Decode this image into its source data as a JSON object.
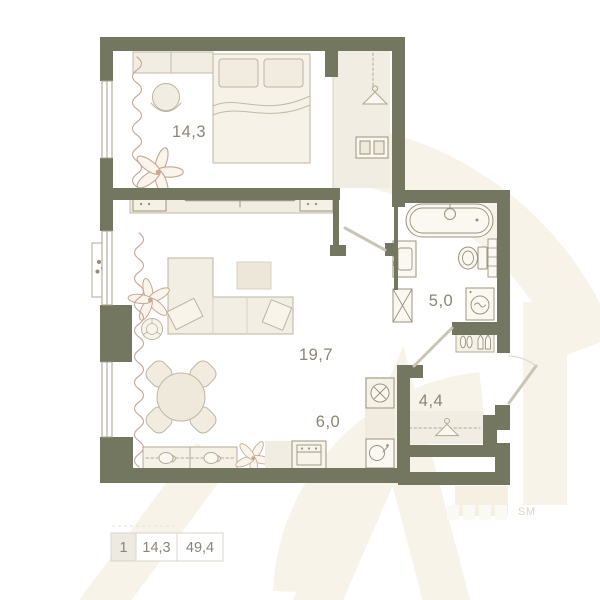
{
  "plan": {
    "type": "apartment-floor-plan",
    "labels": {
      "bedroom": "14,3",
      "living": "19,7",
      "bathroom": "5,0",
      "kitchen": "6,0",
      "hall": "4,4"
    },
    "rooms": [
      {
        "name": "bedroom",
        "area_m2": "14,3"
      },
      {
        "name": "living-room",
        "area_m2": "19,7"
      },
      {
        "name": "bathroom",
        "area_m2": "5,0"
      },
      {
        "name": "kitchen",
        "area_m2": "6,0"
      },
      {
        "name": "hallway",
        "area_m2": "4,4"
      }
    ],
    "fixtures": [
      "bed",
      "closet",
      "wardrobe-hanger",
      "drawer-cabinet",
      "armchair",
      "plant",
      "curtains",
      "tv-console",
      "sofa",
      "coffee-table",
      "pouf",
      "dining-table",
      "dining-chairs",
      "kitchen-counter",
      "stove",
      "cooker-hood",
      "kitchen-sink",
      "bathtub",
      "bathroom-sink",
      "toilet",
      "towel-rail",
      "washing-machine",
      "ventilation-shaft",
      "shoe-rack",
      "coat-hanger",
      "entrance-door",
      "interior-doors",
      "windows",
      "balcony-shelf"
    ]
  },
  "legend": {
    "rooms_count": "1",
    "living_area": "14,3",
    "total_area": "49,4"
  },
  "watermark": {
    "trademark_suffix": "SM"
  },
  "colors": {
    "wall": "#747760",
    "furniture_fill": "#f2ede2",
    "furniture_stroke": "#bcb4a0",
    "plumbing_stroke": "#a8a18c",
    "soft_line": "#c7a795",
    "label_text": "#8c8576",
    "watermark_cream": "#f7f3e9",
    "legend_cell_bg": "#edeae1",
    "legend_border": "#d9d5c9"
  }
}
